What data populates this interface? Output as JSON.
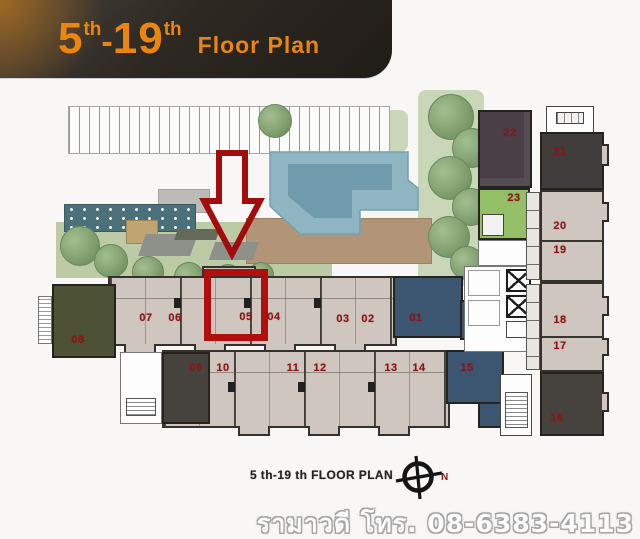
{
  "banner": {
    "big1": "5",
    "sup1": "th",
    "dash": "-",
    "big2": "19",
    "sup2": "th",
    "title": "Floor Plan"
  },
  "units": {
    "u01": "01",
    "u02": "02",
    "u03": "03",
    "u04": "04",
    "u05": "05",
    "u06": "06",
    "u07": "07",
    "u08": "08",
    "u09": "09",
    "u10": "10",
    "u11": "11",
    "u12": "12",
    "u13": "13",
    "u14": "14",
    "u15": "15",
    "u16": "16",
    "u17": "17",
    "u18": "18",
    "u19": "19",
    "u20": "20",
    "u21": "21",
    "u22": "22",
    "u23": "23"
  },
  "highlight": {
    "highlighted_unit": "05",
    "box_color": "#b30e0e",
    "arrow_color": "#a30c0c"
  },
  "caption": {
    "floor_label": "5 th-19 th FLOOR PLAN",
    "compass_north": "N"
  },
  "watermark": {
    "text": "รามาวดี โทร. 08-6383-4113"
  },
  "colors": {
    "banner_bg": "#2d2822",
    "banner_text": "#ea850e",
    "unit_number_red": "#8c1616",
    "pool_blue": "#8fb5c3",
    "pool_inner_blue": "#6b97a8",
    "lawn_green": "#bccaa5",
    "tree_green": "#7d9c6b",
    "deck_brown": "#b29577",
    "teal_strip": "#4a717a",
    "unit_tan": "#cfc6bf",
    "unit_dark_blue": "#3c5570",
    "unit_olive": "#4d5136",
    "unit_dark_gray": "#46433f",
    "unit_purple": "#4a3f46",
    "unit_green": "#93bf66"
  }
}
